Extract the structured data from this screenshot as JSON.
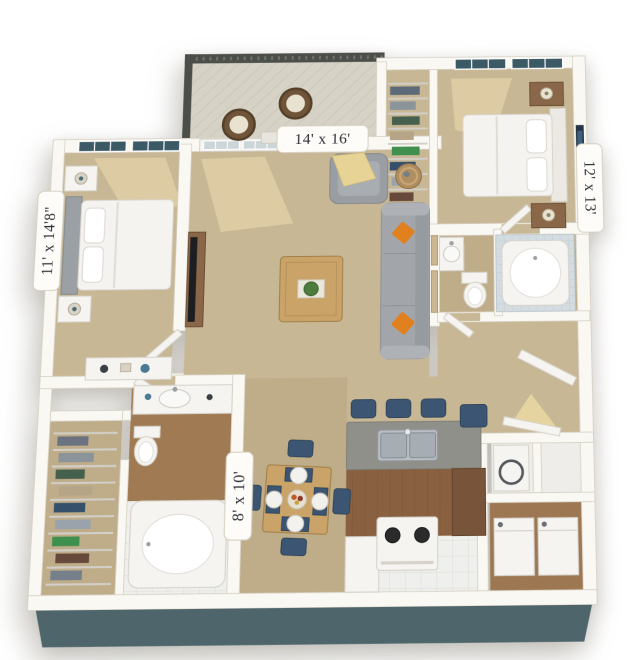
{
  "image_type": "3d-floor-plan-rendering",
  "floorplan": {
    "background": "#ffffff",
    "labels": {
      "living_room": "14' x 16'",
      "bedroom_right": "12' x 13'",
      "bedroom_left": "11' x 14'8\"",
      "dining": "8' x 10'"
    },
    "rooms": [
      {
        "id": "balcony",
        "furniture": [
          "railing",
          "wicker-chair",
          "wicker-chair",
          "patio-table"
        ]
      },
      {
        "id": "closet-top",
        "furniture": [
          "wire-shelves",
          "clothes"
        ]
      },
      {
        "id": "bedroom-right",
        "label_key": "bedroom_right",
        "furniture": [
          "double-window",
          "bed",
          "nightstand",
          "nightstand",
          "lamp",
          "lamp",
          "wall-art"
        ]
      },
      {
        "id": "bedroom-left",
        "label_key": "bedroom_left",
        "furniture": [
          "double-window",
          "bed",
          "nightstand",
          "nightstand",
          "lamp",
          "lamp",
          "wall-art",
          "dresser"
        ]
      },
      {
        "id": "living-room",
        "label_key": "living_room",
        "furniture": [
          "french-door",
          "sidelight-window",
          "tv-console",
          "tv",
          "sofa",
          "throw-pillows",
          "armchair",
          "throw-blanket",
          "side-table",
          "coffee-table",
          "plant",
          "wall-frames"
        ]
      },
      {
        "id": "bathroom-right",
        "furniture": [
          "bathtub",
          "tile-surround",
          "toilet",
          "vanity-sink",
          "door"
        ]
      },
      {
        "id": "hallway",
        "furniture": [
          "entry-door",
          "light-spill",
          "bin"
        ]
      },
      {
        "id": "dining",
        "label_key": "dining",
        "furniture": [
          "dining-table",
          "chair",
          "chair",
          "chair",
          "chair",
          "place-settings",
          "fruit-bowl"
        ]
      },
      {
        "id": "kitchen",
        "furniture": [
          "breakfast-bar",
          "double-sink",
          "bar-stool",
          "bar-stool",
          "bar-stool",
          "stove",
          "cabinets"
        ]
      },
      {
        "id": "bathroom-left",
        "furniture": [
          "vanity-sink",
          "toilet",
          "bathtub",
          "door"
        ]
      },
      {
        "id": "walk-in-closet",
        "furniture": [
          "wire-shelves",
          "clothes"
        ]
      },
      {
        "id": "utility",
        "furniture": [
          "washer",
          "dryer",
          "storage-cubby",
          "storage-cubby"
        ]
      }
    ],
    "colors": {
      "wall": "#faf8f3",
      "wall_line": "#d6d0c2",
      "carpet": "#c8b795",
      "carpet_dark": "#bfad89",
      "tile": "#eff0ed",
      "wood_floor": "#8a6140",
      "wood": "#c9a368",
      "wood_dark": "#8a6748",
      "cabinet": "#77543a",
      "counter": "#90908a",
      "fixture": "#f5f4f0",
      "fixture_line": "#d6d2ca",
      "blue": "#3c5572",
      "orange": "#e0801f",
      "yellow": "#e7d395",
      "glass_dark": "#3c5a66",
      "glass_light": "#ccd6d8",
      "railing": "#4b4e49",
      "sofa": "#a2a6aa",
      "art": "#263545",
      "sun": "#eeddae",
      "tub_tile": "#d3dce0",
      "shadow_face": "#4e666b"
    }
  }
}
